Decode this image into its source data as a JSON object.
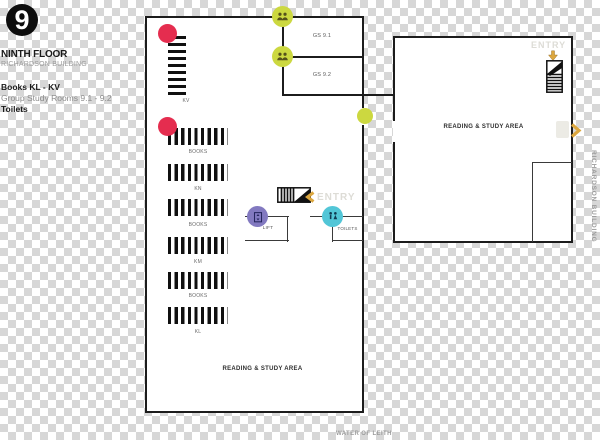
{
  "legend": {
    "floor_number": "9",
    "floor_name": "NINTH FLOOR",
    "building_name": "RICHARDSON BUILDING",
    "items": [
      {
        "label": "Books KL - KV"
      },
      {
        "label": "Group Study Rooms 9.1 - 9.2"
      },
      {
        "label": "Toilets"
      }
    ]
  },
  "plan": {
    "rooms": {
      "group_study_1": "GS 9.1",
      "group_study_2": "GS 9.2",
      "lift": "LIFT",
      "toilets": "TOILETS",
      "reading_area_right": "READING & STUDY AREA",
      "reading_area_left": "READING & STUDY AREA"
    },
    "shelf_labels": [
      "BOOKS",
      "KN",
      "BOOKS",
      "KM",
      "BOOKS",
      "KL"
    ],
    "vertical_shelf_label": "KV",
    "entry_top_label": "ENTRY",
    "entry_mid_label": "ENTRY"
  },
  "captions": {
    "water": "WATER OF LEITH",
    "side_building": "RICHARDSON BUILDING"
  },
  "markers": {
    "book_section_markers": {
      "shape": "circle",
      "color": "#e52d4f"
    },
    "group_study_markers": {
      "shape": "circle",
      "color": "#ccd840",
      "icon": "people-icon"
    },
    "lift_marker": {
      "shape": "circle",
      "color": "#8279c0",
      "icon": "lift-icon"
    },
    "toilets_marker": {
      "shape": "circle",
      "color": "#52c6d7",
      "icon": "wc-icon"
    },
    "entry_arrows": {
      "color": "#dca73f"
    }
  },
  "colors": {
    "wall": "#1c1c1c",
    "checker_gray": "#d7d7d7",
    "faint_text": "#dddcd6",
    "gold": "#dca73f"
  }
}
